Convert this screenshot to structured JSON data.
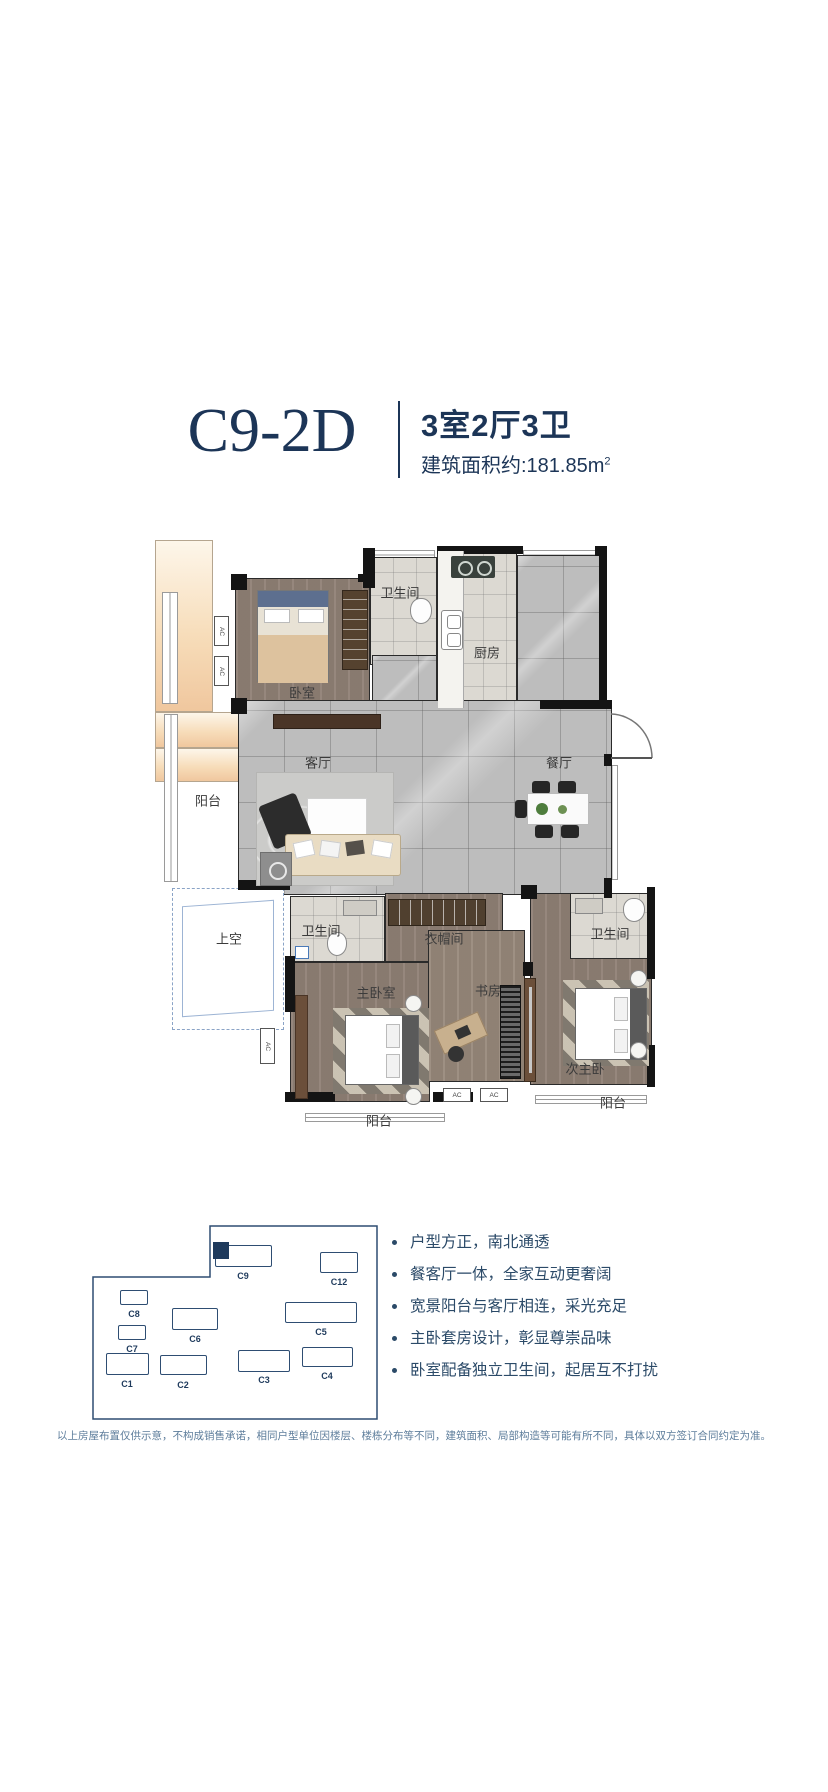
{
  "header": {
    "unit_code": "C9-2D",
    "layout": "3室2厅3卫",
    "area_text": "建筑面积约:181.85m",
    "area_sup": "2"
  },
  "plan": {
    "ac_label": "AC",
    "labels": [
      {
        "id": "bath-top",
        "text": "卫生间"
      },
      {
        "id": "kitchen",
        "text": "厨房"
      },
      {
        "id": "bedroom-top",
        "text": "卧室"
      },
      {
        "id": "living",
        "text": "客厅"
      },
      {
        "id": "dining",
        "text": "餐厅"
      },
      {
        "id": "balcony-left",
        "text": "阳台"
      },
      {
        "id": "void",
        "text": "上空"
      },
      {
        "id": "bath-mid",
        "text": "卫生间"
      },
      {
        "id": "cloakroom",
        "text": "衣帽间"
      },
      {
        "id": "master-bedroom",
        "text": "主卧室"
      },
      {
        "id": "study",
        "text": "书房"
      },
      {
        "id": "bath-right",
        "text": "卫生间"
      },
      {
        "id": "second-master",
        "text": "次主卧"
      },
      {
        "id": "balcony-bottom",
        "text": "阳台"
      },
      {
        "id": "balcony-right",
        "text": "阳台"
      }
    ]
  },
  "site": {
    "buildings": [
      {
        "label": "C9",
        "highlighted": true
      },
      {
        "label": "C12",
        "highlighted": false
      },
      {
        "label": "C8",
        "highlighted": false
      },
      {
        "label": "C6",
        "highlighted": false
      },
      {
        "label": "C5",
        "highlighted": false
      },
      {
        "label": "C7",
        "highlighted": false
      },
      {
        "label": "C1",
        "highlighted": false
      },
      {
        "label": "C2",
        "highlighted": false
      },
      {
        "label": "C3",
        "highlighted": false
      },
      {
        "label": "C4",
        "highlighted": false
      }
    ]
  },
  "features": {
    "items": [
      "户型方正，南北通透",
      "餐客厅一体，全家互动更奢阔",
      "宽景阳台与客厅相连，采光充足",
      "主卧套房设计，彰显尊崇品味",
      "卧室配备独立卫生间，起居互不打扰"
    ]
  },
  "disclaimer": "以上房屋布置仅供示意，不构成销售承诺，相同户型单位因楼层、楼栋分布等不同，建筑面积、局部构造等可能有所不同，具体以双方签订合同约定为准。",
  "colors": {
    "accent_navy": "#1c3557",
    "balcony_peach": "#f0c79e",
    "wood_floor": "#8f8075",
    "tile_gray": "#bdbdbd"
  }
}
